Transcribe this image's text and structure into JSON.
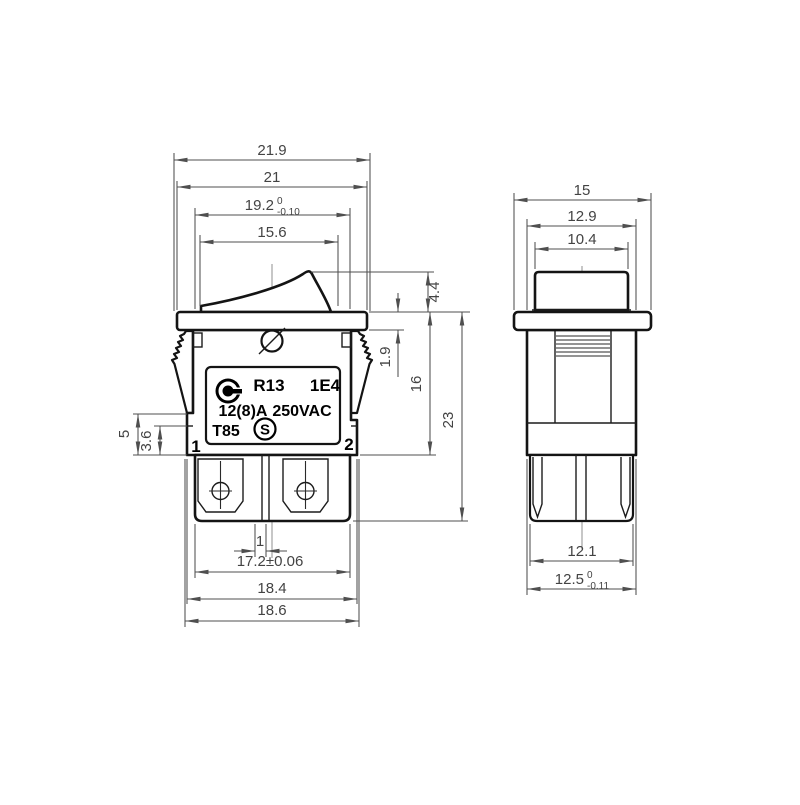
{
  "colors": {
    "outline": "#141414",
    "dimension": "#4f4f4f",
    "centerline": "#8f8f8f",
    "background": "#ffffff"
  },
  "front_view": {
    "plate": {
      "model": "R13",
      "type_code": "1E4",
      "current": "12(8)A",
      "voltage": "250VAC",
      "temp_rating": "T85",
      "s_mark": "S"
    },
    "terminal_left": "1",
    "terminal_right": "2",
    "dims": {
      "width_outer": "21.9",
      "width_flange": "21",
      "width_upper_val": "19.2",
      "width_upper_tol_hi": "0",
      "width_upper_tol_lo": "-0.10",
      "width_rocker": "15.6",
      "rocker_height": "4.4",
      "flange_thickness": "1.9",
      "body_depth": "16",
      "total_depth": "23",
      "leg_tip": "5",
      "leg_step": "3.6",
      "terminal_offset": "1",
      "block_width": "17.2±0.06",
      "body_width": "18.4",
      "base_width": "18.6"
    }
  },
  "side_view": {
    "dims": {
      "flange_width": "15",
      "body_width": "12.9",
      "button_width": "10.4",
      "block_width": "12.1",
      "base_width_val": "12.5",
      "base_width_tol_hi": "0",
      "base_width_tol_lo": "-0.11"
    }
  }
}
